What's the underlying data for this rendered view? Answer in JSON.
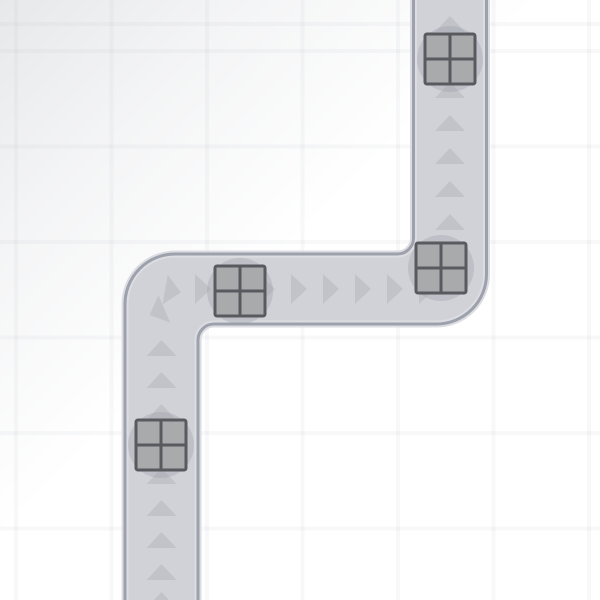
{
  "scene": {
    "background": {
      "base_color": "#ffffff",
      "vignette_gradient": "linear-gradient(135deg, rgba(162,167,176,0.26) 0%, rgba(162,167,176,0.12) 20%, rgba(162,167,176,0) 45%)",
      "grid_line_color": "rgba(84,94,114,0.045)",
      "grid_spacing": 95.5,
      "grid_line_width": 4,
      "grid_offset_x": 14,
      "grid_offset_y": 49
    },
    "road": {
      "fill_color": "#d1d2d7",
      "border_color": "#9da1ab",
      "highlight_color": "#dcdde2",
      "border_width": 3,
      "highlight_width": 7,
      "outline_path": "M 125 605 L 125 304 A 50 50 0 0 1 175 254 L 397.5 254 A 16 16 0 0 0 413.5 238 L 413.5 -5 L 486.5 -5 L 486.5 274 A 50 50 0 0 1 436.5 324 L 214 324 A 16 16 0 0 0 198 340 L 198 605 Z"
    },
    "arrows": {
      "color": "#c2c3c9",
      "base_width": 30,
      "height": 16,
      "items": [
        {
          "x": 450,
          "y": -8,
          "rot": 0
        },
        {
          "x": 450,
          "y": 24,
          "rot": 0
        },
        {
          "x": 450,
          "y": 57,
          "rot": 0
        },
        {
          "x": 450,
          "y": 90,
          "rot": 0
        },
        {
          "x": 450,
          "y": 123,
          "rot": 0
        },
        {
          "x": 450,
          "y": 156,
          "rot": 0
        },
        {
          "x": 450,
          "y": 189,
          "rot": 0
        },
        {
          "x": 450,
          "y": 222,
          "rot": 0
        },
        {
          "x": 203,
          "y": 289,
          "rot": 90
        },
        {
          "x": 235,
          "y": 289,
          "rot": 90
        },
        {
          "x": 267,
          "y": 289,
          "rot": 90
        },
        {
          "x": 299,
          "y": 289,
          "rot": 90
        },
        {
          "x": 331,
          "y": 289,
          "rot": 90
        },
        {
          "x": 363,
          "y": 289,
          "rot": 90
        },
        {
          "x": 395,
          "y": 289,
          "rot": 90
        },
        {
          "x": 427,
          "y": 289,
          "rot": 90
        },
        {
          "x": 173,
          "y": 291,
          "rot": 100
        },
        {
          "x": 157,
          "y": 312,
          "rot": 247
        },
        {
          "x": 161.5,
          "y": 348,
          "rot": 0
        },
        {
          "x": 161.5,
          "y": 380,
          "rot": 0
        },
        {
          "x": 161.5,
          "y": 412,
          "rot": 0
        },
        {
          "x": 161.5,
          "y": 444,
          "rot": 0
        },
        {
          "x": 161.5,
          "y": 476,
          "rot": 0
        },
        {
          "x": 161.5,
          "y": 508,
          "rot": 0
        },
        {
          "x": 161.5,
          "y": 540,
          "rot": 0
        },
        {
          "x": 161.5,
          "y": 572,
          "rot": 0
        },
        {
          "x": 161.5,
          "y": 600,
          "rot": 0
        }
      ]
    },
    "crates": {
      "size": 50,
      "corner_radius": 2,
      "fill_color": "#a9aaac",
      "border_color": "#595a5f",
      "border_width": 3,
      "shadow_color": "rgba(150,153,161,0.30)",
      "shadow_radius": 33,
      "items": [
        {
          "x": 450,
          "y": 59
        },
        {
          "x": 441,
          "y": 268
        },
        {
          "x": 240,
          "y": 291
        },
        {
          "x": 161,
          "y": 445
        }
      ]
    }
  }
}
